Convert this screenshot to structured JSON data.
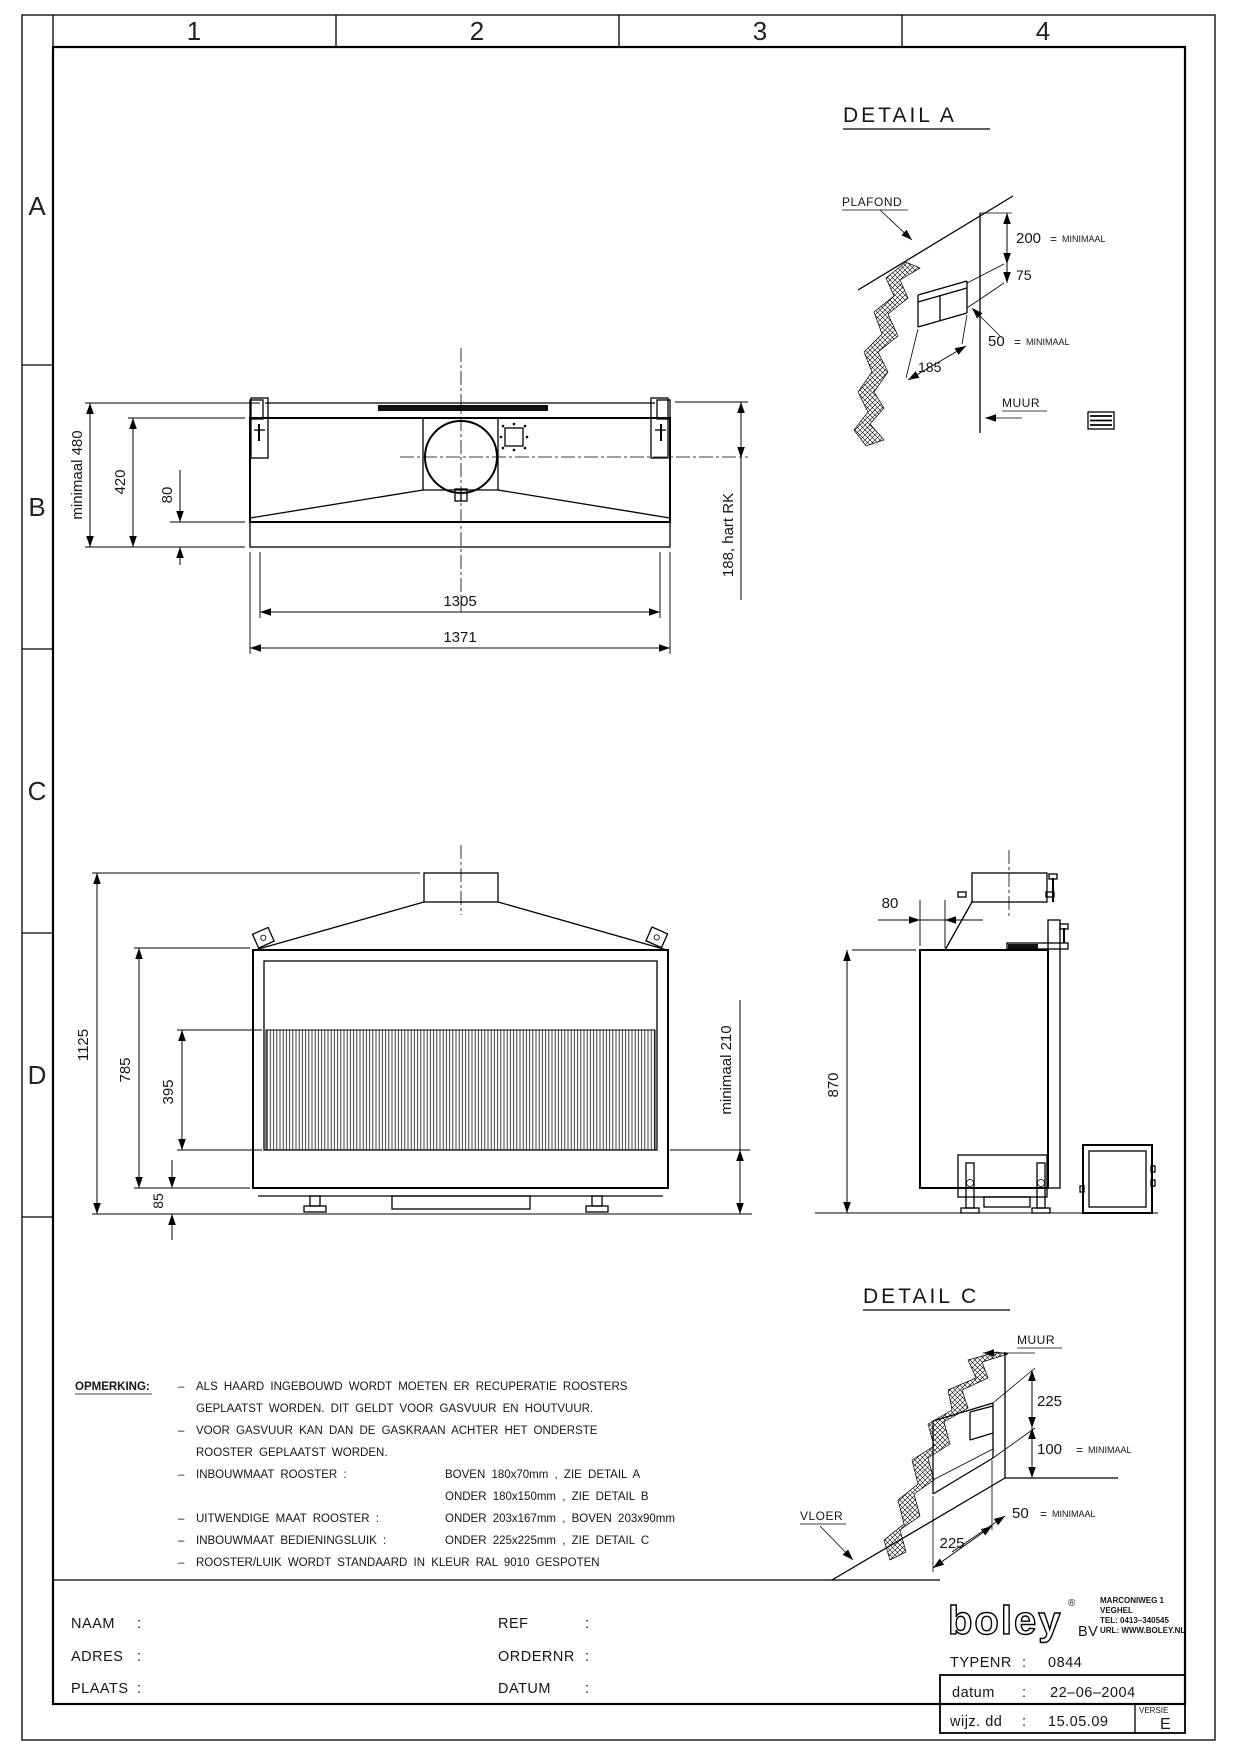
{
  "sheet": {
    "grid_cols": [
      "1",
      "2",
      "3",
      "4"
    ],
    "grid_rows": [
      "A",
      "B",
      "C",
      "D"
    ]
  },
  "plan_view": {
    "dims": {
      "overall_height": "minimaal 480",
      "inner_height": "420",
      "rim": "80",
      "inner_width": "1305",
      "overall_width": "1371",
      "flue_offset": "188, hart RK"
    }
  },
  "front_view": {
    "dims": {
      "total_height": "1125",
      "body_height": "785",
      "glass_height": "395",
      "plinth": "85",
      "floor_clearance": "minimaal 210"
    }
  },
  "side_view": {
    "dims": {
      "depth_gap": "80",
      "height": "870"
    }
  },
  "detail_a": {
    "title": "DETAIL  A",
    "plafond": "PLAFOND",
    "muur": "MUUR",
    "d200": "200",
    "d200_eq": "=",
    "d200_min": "MINIMAAL",
    "d75": "75",
    "d50": "50",
    "d50_eq": "=",
    "d50_min": "MINIMAAL",
    "d185": "185"
  },
  "detail_c": {
    "title": "DETAIL  C",
    "muur": "MUUR",
    "vloer": "VLOER",
    "d225_top": "225",
    "d100": "100",
    "d100_eq": "=",
    "d100_min": "MINIMAAL",
    "d50": "50",
    "d50_eq": "=",
    "d50_min": "MINIMAAL",
    "d225_bottom": "225"
  },
  "opmerking": {
    "heading": "OPMERKING:",
    "rows": [
      {
        "dash": "–",
        "left": "ALS  HAARD  INGEBOUWD  WORDT  MOETEN  ER  RECUPERATIE  ROOSTERS",
        "right": ""
      },
      {
        "dash": "",
        "left": "GEPLAATST  WORDEN.  DIT  GELDT  VOOR  GASVUUR  EN  HOUTVUUR.",
        "right": ""
      },
      {
        "dash": "–",
        "left": "VOOR  GASVUUR  KAN  DAN  DE  GASKRAAN  ACHTER  HET  ONDERSTE",
        "right": ""
      },
      {
        "dash": "",
        "left": "ROOSTER  GEPLAATST  WORDEN.",
        "right": ""
      },
      {
        "dash": "–",
        "left": "INBOUWMAAT  ROOSTER :",
        "right": "BOVEN  180x70mm , ZIE  DETAIL  A"
      },
      {
        "dash": "",
        "left": "",
        "right": "ONDER  180x150mm , ZIE  DETAIL  B"
      },
      {
        "dash": "–",
        "left": "UITWENDIGE  MAAT  ROOSTER :",
        "right": "ONDER  203x167mm , BOVEN  203x90mm"
      },
      {
        "dash": "–",
        "left": "INBOUWMAAT  BEDIENINGSLUIK :",
        "right": "ONDER  225x225mm , ZIE  DETAIL  C"
      },
      {
        "dash": "–",
        "left": "ROOSTER/LUIK  WORDT  STANDAARD  IN  KLEUR  RAL  9010  GESPOTEN",
        "right": ""
      }
    ]
  },
  "title_block": {
    "left_fields": [
      {
        "label": "NAAM",
        "sep": ":"
      },
      {
        "label": "ADRES",
        "sep": ":"
      },
      {
        "label": "PLAATS",
        "sep": ":"
      }
    ],
    "mid_fields": [
      {
        "label": "REF",
        "sep": ":"
      },
      {
        "label": "ORDERNR",
        "sep": ":"
      },
      {
        "label": "DATUM",
        "sep": ":"
      }
    ],
    "logo_text": "boley",
    "logo_reg": "®",
    "logo_bv": "BV",
    "address": [
      "MARCONIWEG 1",
      "VEGHEL",
      "TEL:  0413–340545",
      "URL:  WWW.BOLEY.NL"
    ],
    "typenr_label": "TYPENR",
    "typenr_sep": ":",
    "typenr_value": "0844",
    "datum_label": "datum",
    "datum_sep": ":",
    "datum_value": "22–06–2004",
    "wijz_label": "wijz. dd",
    "wijz_sep": ":",
    "wijz_value": "15.05.09",
    "versie_label": "VERSIE",
    "versie_value": "E"
  }
}
